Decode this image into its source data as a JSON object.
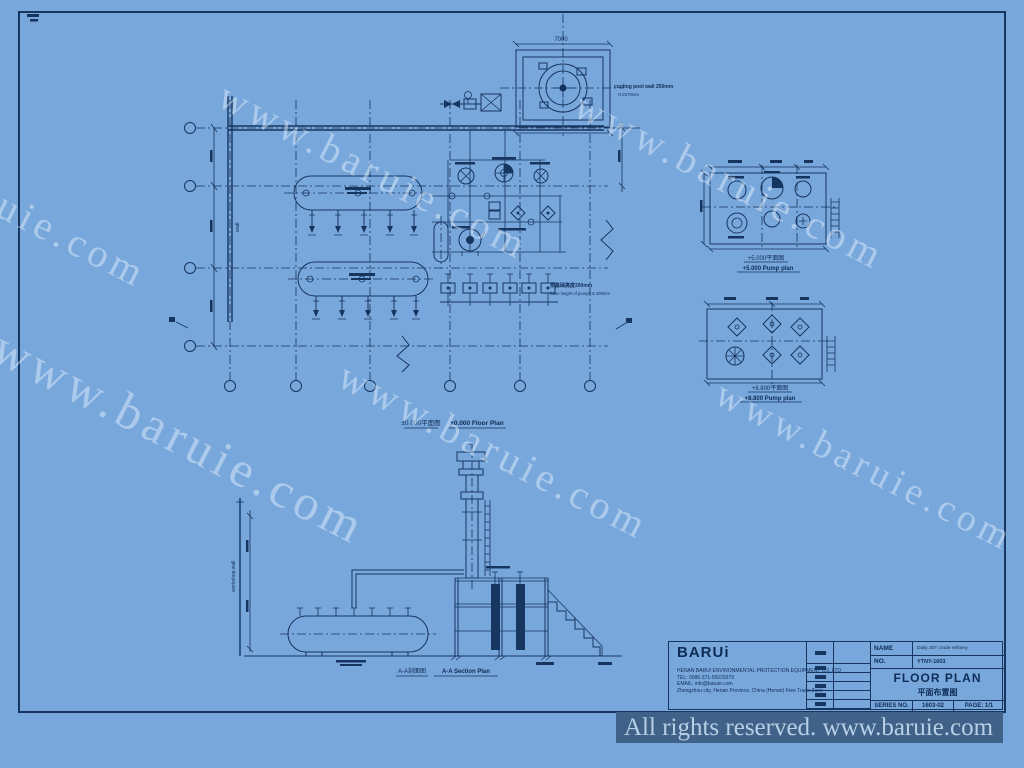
{
  "sheet": {
    "background_color": "#78a7dc",
    "line_color": "#16355f"
  },
  "watermark": {
    "text": "www.baruie.com"
  },
  "footer": {
    "text": "All rights reserved. www.baruie.com"
  },
  "views": {
    "floor_plan": {
      "caption_zh": "±0.000平面图",
      "caption_en": "±0.000 Floor Plan"
    },
    "plan_5000": {
      "caption_zh": "+5.000平面图",
      "caption_en": "+5.000 Pump plan"
    },
    "plan_8800": {
      "caption_zh": "+8.800平面图",
      "caption_en": "+8.800 Pump plan"
    },
    "section": {
      "caption_zh": "A-A剖面图",
      "caption_en": "A-A Section Plan"
    }
  },
  "annotations": {
    "pool_wall_note": "cooling pool wall 250mm",
    "pool_depth_note": "H:2370mm",
    "pump_base_note_zh": "泵基础高度200mm",
    "pump_base_note_en": "Base height of pumps is 200mm",
    "wall_label": "wall",
    "workshop_wall_label": "workshop wall",
    "dim_pool_width": "7000"
  },
  "title_block": {
    "logo": "BARUi",
    "company_line1": "HENAN BARUI ENVIRONMENTAL PROTECTION EQUIPMENT CO.,LTD",
    "company_line2": "TEL: 0086-371-55029379",
    "company_line3": "EMAIL: info@baruie.com",
    "company_line4": "Zhengzhou city, Henan Province, China (Henan) Free Trade Zone",
    "name_label": "NAME",
    "name_value": "Daily 30T crude refinery",
    "no_label": "NO.",
    "no_value": "YTNY-1603",
    "title_en": "FLOOR PLAN",
    "title_zh": "平面布置图",
    "series_label": "SERIES NO.",
    "series_value": "1603-02",
    "page_label": "PAGE: 1/1"
  }
}
